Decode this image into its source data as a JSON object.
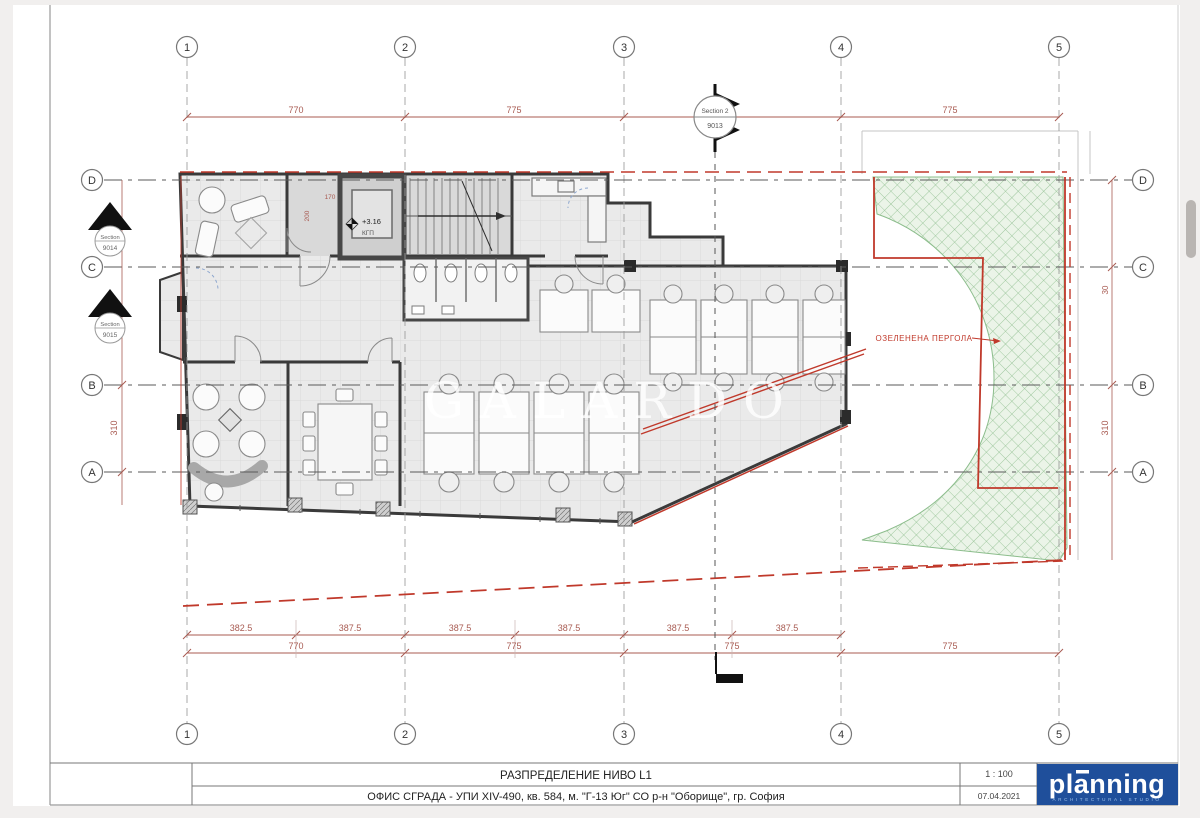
{
  "sheet": {
    "title_row1": "РАЗПРЕДЕЛЕНИЕ НИВО L1",
    "title_row2": "ОФИС СГРАДА - УПИ XIV-490, кв. 584, м. \"Г-13 Юг\" СО р-н \"Оборище\", гр. София",
    "scale": "1 : 100",
    "date": "07.04.2021",
    "logo_text": "planning",
    "logo_subtext": "ARCHITECTURAL STUDIO"
  },
  "grid": {
    "columns": [
      "1",
      "2",
      "3",
      "4",
      "5"
    ],
    "rows": [
      "D",
      "C",
      "B",
      "A"
    ]
  },
  "dims": {
    "top": [
      "770",
      "775",
      "775"
    ],
    "bottom_detail": [
      "382.5",
      "387.5",
      "387.5",
      "387.5",
      "387.5",
      "387.5"
    ],
    "bottom_main": [
      "770",
      "775",
      "775",
      "775"
    ],
    "left": [
      "310"
    ],
    "right": [
      "30",
      "310"
    ],
    "elevator_w": "170",
    "elevator_h": "200"
  },
  "sections": {
    "top1": "Section 2",
    "top2": "9013",
    "left_upper1": "Section",
    "left_upper2": "9014",
    "left_lower1": "Section",
    "left_lower2": "9015"
  },
  "annotations": {
    "pergola": "ОЗЕЛЕНЕНА ПЕРГОЛА",
    "level": "+3.16",
    "level_sub": "КГП",
    "watermark": "GALARDO"
  },
  "colors": {
    "red_boundary": "#c0392b",
    "dim": "#a85b52",
    "green_line": "#8cbd8c",
    "green_fill": "#ebf4e8",
    "wall": "#3a3a3a",
    "logo_bg": "#1f4f9b"
  }
}
